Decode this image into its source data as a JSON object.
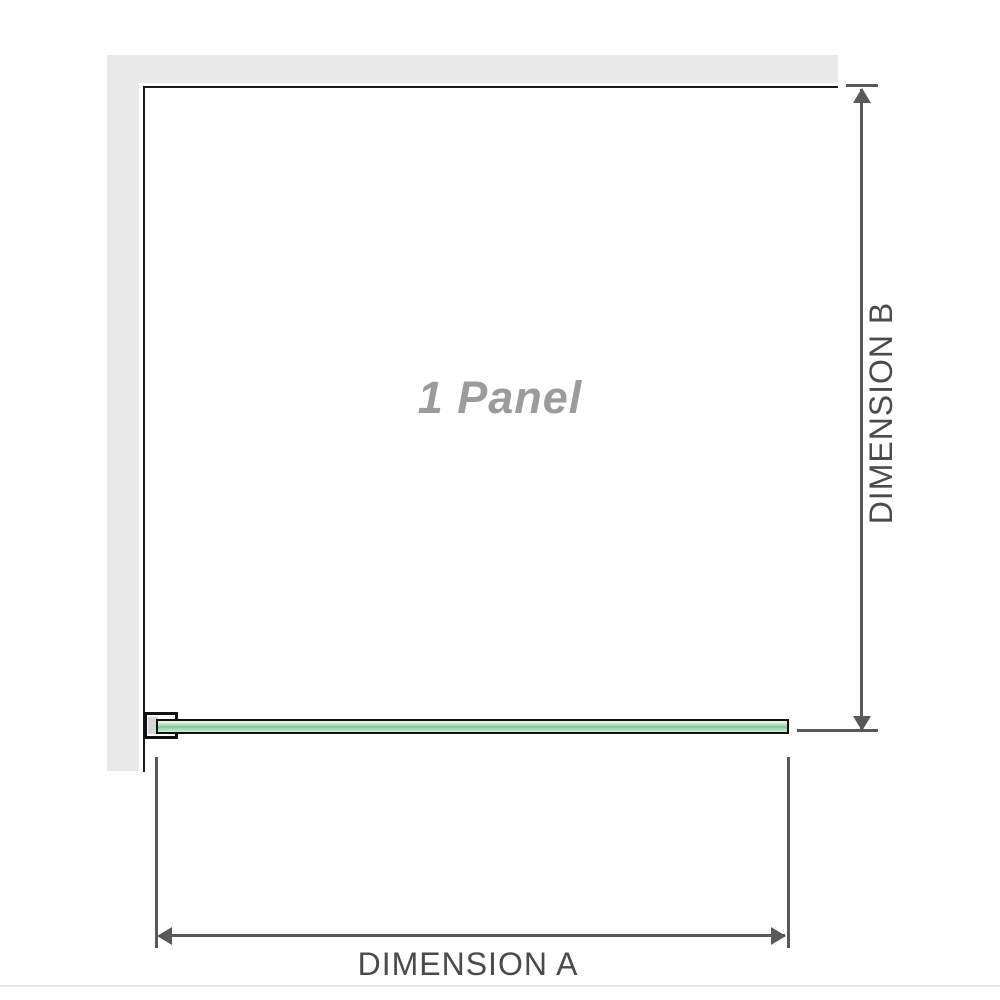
{
  "diagram": {
    "title": "shower screen panel dimension diagram",
    "panel_label": "1 Panel",
    "dimension_a": {
      "label": "DIMENSION A",
      "orientation": "horizontal"
    },
    "dimension_b": {
      "label": "DIMENSION B",
      "orientation": "vertical"
    },
    "colors": {
      "wall_gray": "#e9e9e9",
      "outline_black": "#1a1a1a",
      "glass_green": "#97d3a8",
      "glass_green_light": "#edf7ec",
      "dimension_line_gray": "#58595b",
      "dimension_text_gray": "#4b4b4d",
      "panel_label_gray": "#9b9b9b",
      "bracket_pad_gray": "#d6d6d6"
    }
  }
}
